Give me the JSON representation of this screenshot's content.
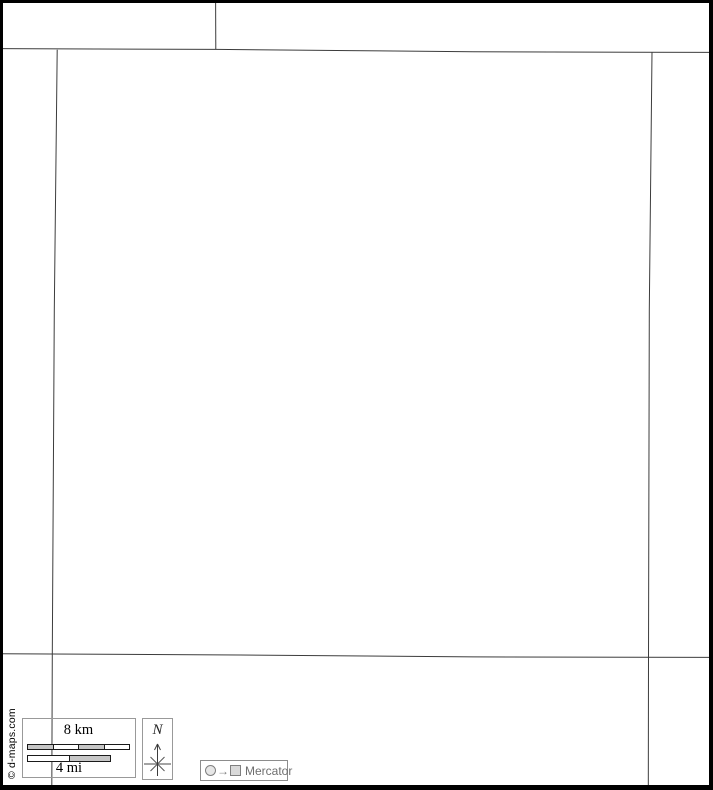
{
  "map": {
    "copyright": "© d-maps.com",
    "line_color": "#3c3c3c",
    "boundaries": {
      "top_spur": [
        [
          215.6,
          0
        ],
        [
          215.8,
          49.4
        ]
      ],
      "north_edge": [
        [
          0,
          48.6
        ],
        [
          216,
          49.4
        ],
        [
          350,
          50.6
        ],
        [
          473,
          51.8
        ],
        [
          713,
          52.4
        ]
      ],
      "west_edge": [
        [
          57.2,
          49.7
        ],
        [
          54.3,
          310
        ],
        [
          52.3,
          653.6
        ],
        [
          51.8,
          790
        ]
      ],
      "east_edge": [
        [
          652.0,
          52.0
        ],
        [
          649.3,
          310
        ],
        [
          648.5,
          657.2
        ],
        [
          648.3,
          790
        ]
      ],
      "south_edge": [
        [
          0,
          653.7
        ],
        [
          240,
          655.0
        ],
        [
          473,
          656.9
        ],
        [
          713,
          657.4
        ]
      ]
    }
  },
  "scale_bar": {
    "km_label": "8 km",
    "mi_label": "4 mi",
    "km_segment_fills": [
      "#c6c6c6",
      "#ffffff",
      "#c6c6c6",
      "#ffffff"
    ],
    "mi_segment_fills": [
      "#ffffff",
      "#c6c6c6"
    ]
  },
  "north_indicator": {
    "label": "N"
  },
  "projection_legend": {
    "arrow": "→",
    "label": "Mercator"
  }
}
